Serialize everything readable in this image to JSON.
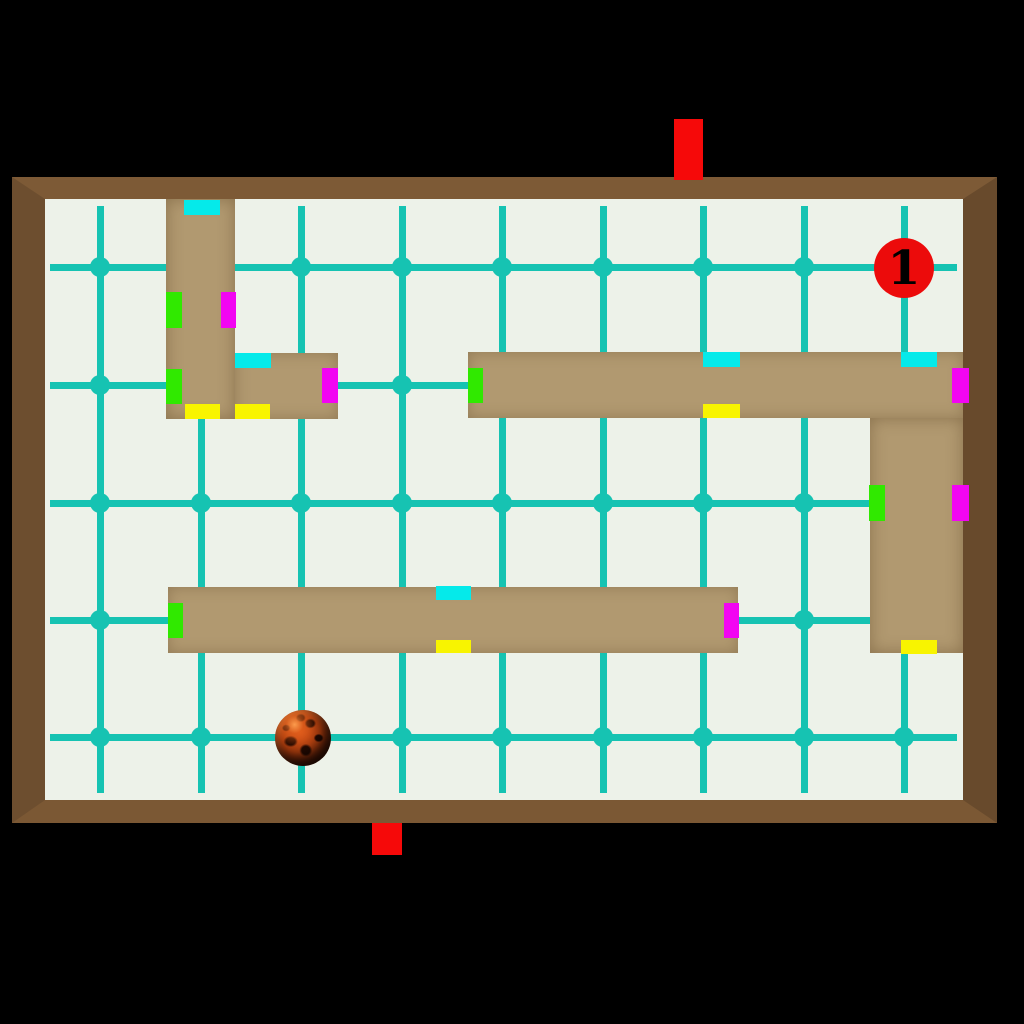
{
  "scene": {
    "description": "tilt marble maze level viewed from above",
    "level_label": "1"
  },
  "colors": {
    "outside": "#000000",
    "field": "#edf2e9",
    "grid": "#16c3b2",
    "frame_top": "#7d5a36",
    "frame_left": "#6d4e2f",
    "frame_right": "#684a2c",
    "frame_bottom": "#7b5834",
    "wall": "#b19970",
    "marker_green": "#30e900",
    "marker_magenta": "#f205f2",
    "marker_cyan": "#05eaea",
    "marker_yellow": "#f8f400",
    "exit_red": "#f60909",
    "token_red": "#ec0b0b",
    "token_text": "#000000"
  },
  "field": {
    "x": 45,
    "y": 199,
    "w": 918,
    "h": 601
  },
  "frame": {
    "x": 12,
    "y": 177,
    "w": 985,
    "h": 646,
    "border_top": 22,
    "border_left": 33,
    "border_right": 34,
    "border_bottom": 23
  },
  "grid": {
    "v_xs": [
      100,
      201,
      301,
      402,
      502,
      603,
      703,
      804,
      904
    ],
    "h_ys": [
      267,
      385,
      503,
      620,
      737
    ],
    "v_y0": 206,
    "v_y1": 793,
    "h_x0": 50,
    "h_x1": 957,
    "line_w": 7,
    "dot_r": 10
  },
  "walls": [
    {
      "x": 166,
      "y": 199,
      "w": 69,
      "h": 220,
      "grain": "v"
    },
    {
      "x": 235,
      "y": 353,
      "w": 103,
      "h": 66,
      "grain": "h"
    },
    {
      "x": 468,
      "y": 352,
      "w": 495,
      "h": 66,
      "grain": "h"
    },
    {
      "x": 870,
      "y": 418,
      "w": 93,
      "h": 235,
      "grain": "v"
    },
    {
      "x": 168,
      "y": 587,
      "w": 570,
      "h": 66,
      "grain": "h"
    }
  ],
  "markers": [
    {
      "color": "cyan",
      "x": 184,
      "y": 200,
      "w": 36,
      "h": 15
    },
    {
      "color": "green",
      "x": 166,
      "y": 292,
      "w": 16,
      "h": 36
    },
    {
      "color": "magenta",
      "x": 221,
      "y": 292,
      "w": 15,
      "h": 36
    },
    {
      "color": "cyan",
      "x": 235,
      "y": 353,
      "w": 36,
      "h": 15
    },
    {
      "color": "green",
      "x": 166,
      "y": 369,
      "w": 16,
      "h": 35
    },
    {
      "color": "magenta",
      "x": 322,
      "y": 368,
      "w": 16,
      "h": 35
    },
    {
      "color": "yellow",
      "x": 185,
      "y": 404,
      "w": 35,
      "h": 15
    },
    {
      "color": "yellow",
      "x": 235,
      "y": 404,
      "w": 35,
      "h": 15
    },
    {
      "color": "green",
      "x": 468,
      "y": 368,
      "w": 15,
      "h": 35
    },
    {
      "color": "cyan",
      "x": 703,
      "y": 352,
      "w": 37,
      "h": 15
    },
    {
      "color": "yellow",
      "x": 703,
      "y": 404,
      "w": 37,
      "h": 14
    },
    {
      "color": "cyan",
      "x": 901,
      "y": 352,
      "w": 36,
      "h": 15
    },
    {
      "color": "magenta",
      "x": 952,
      "y": 368,
      "w": 17,
      "h": 35
    },
    {
      "color": "green",
      "x": 869,
      "y": 485,
      "w": 16,
      "h": 36
    },
    {
      "color": "magenta",
      "x": 952,
      "y": 485,
      "w": 17,
      "h": 36
    },
    {
      "color": "yellow",
      "x": 901,
      "y": 640,
      "w": 36,
      "h": 14
    },
    {
      "color": "green",
      "x": 168,
      "y": 603,
      "w": 15,
      "h": 35
    },
    {
      "color": "cyan",
      "x": 436,
      "y": 586,
      "w": 35,
      "h": 14
    },
    {
      "color": "yellow",
      "x": 436,
      "y": 640,
      "w": 35,
      "h": 13
    },
    {
      "color": "magenta",
      "x": 724,
      "y": 603,
      "w": 15,
      "h": 35
    }
  ],
  "exits": [
    {
      "side": "top",
      "x": 674,
      "y": 119,
      "w": 29,
      "h": 61
    },
    {
      "side": "bottom",
      "x": 372,
      "y": 823,
      "w": 30,
      "h": 32
    }
  ],
  "token": {
    "label": "1",
    "cx": 904,
    "cy": 268,
    "r": 30
  },
  "ball": {
    "cx": 303,
    "cy": 738,
    "r": 28
  }
}
